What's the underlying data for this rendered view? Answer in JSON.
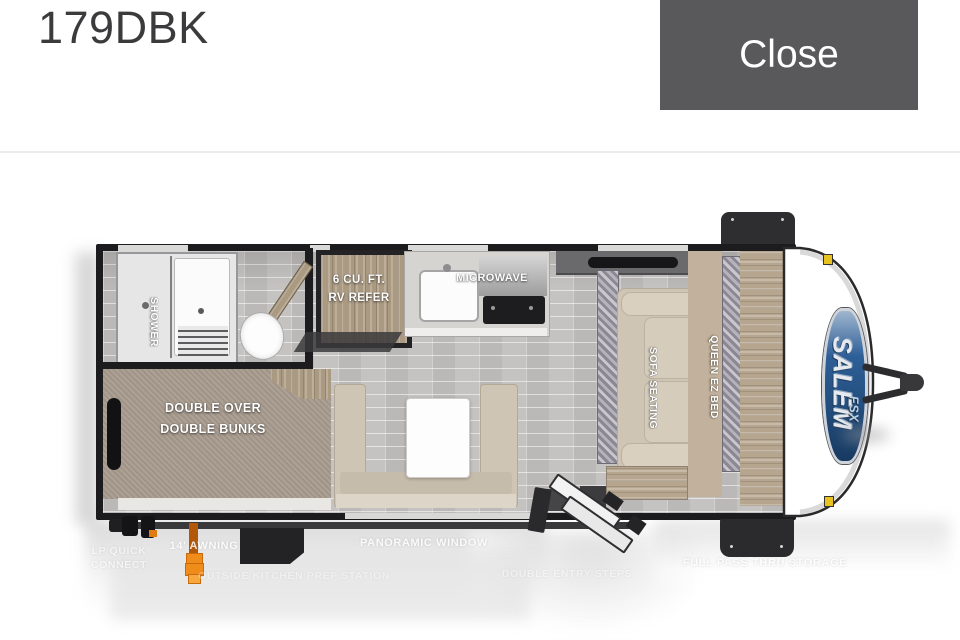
{
  "header": {
    "title": "179DBK",
    "close_label": "Close"
  },
  "floorplan": {
    "badge": {
      "brand": "SALEM",
      "sub": "FSX"
    },
    "room_labels": {
      "shower": "SHOWER",
      "refer_l1": "6 CU. FT.",
      "refer_l2": "RV REFER",
      "microwave": "MICROWAVE",
      "bunks_l1": "DOUBLE OVER",
      "bunks_l2": "DOUBLE BUNKS",
      "sofa": "SOFA SEATING",
      "queen": "QUEEN EZ BED"
    },
    "feature_labels": {
      "lp_l1": "LP QUICK",
      "lp_l2": "CONNECT",
      "awning": "14' AWNING",
      "panoramic": "PANORAMIC WINDOW",
      "outside_kitchen": "OUTSIDE KITCHEN PREP STATION",
      "entry_steps": "DOUBLE ENTRY STEPS",
      "pass_thru": "FULL PASS THRU STORAGE"
    },
    "colors": {
      "close_bg": "#59595b",
      "wall": "#1c1c1e",
      "accent_orange": "#e8821e",
      "badge_blue": "#2e5f98",
      "carpet": "#a89b8e",
      "sofa_beige": "#cfc5b4"
    }
  }
}
